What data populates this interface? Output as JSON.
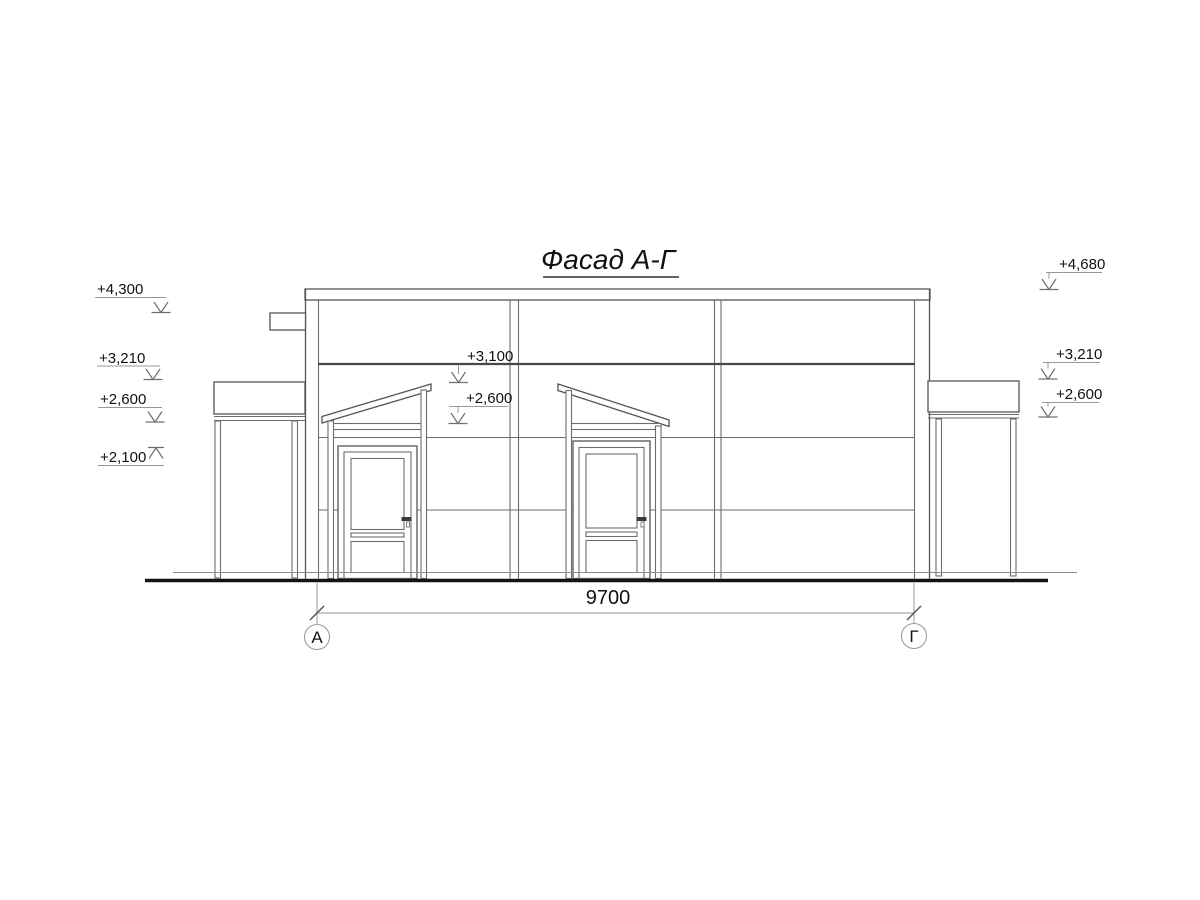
{
  "drawing": {
    "title": "Фасад А-Г",
    "dimension": "9700",
    "axis_left": "А",
    "axis_right": "Г",
    "elev_left_1": "+4,300",
    "elev_left_2": "+3,210",
    "elev_left_3": "+2,600",
    "elev_left_4": "+2,100",
    "elev_mid_1": "+3,100",
    "elev_mid_2": "+2,600",
    "elev_right_1": "+4,680",
    "elev_right_2": "+3,210",
    "elev_right_3": "+2,600",
    "colors": {
      "outline": "#555555",
      "panel_line": "#6d6d6d",
      "dark_band": "#474747",
      "ground": "#141414",
      "leader": "#979797",
      "text": "#111111"
    }
  }
}
